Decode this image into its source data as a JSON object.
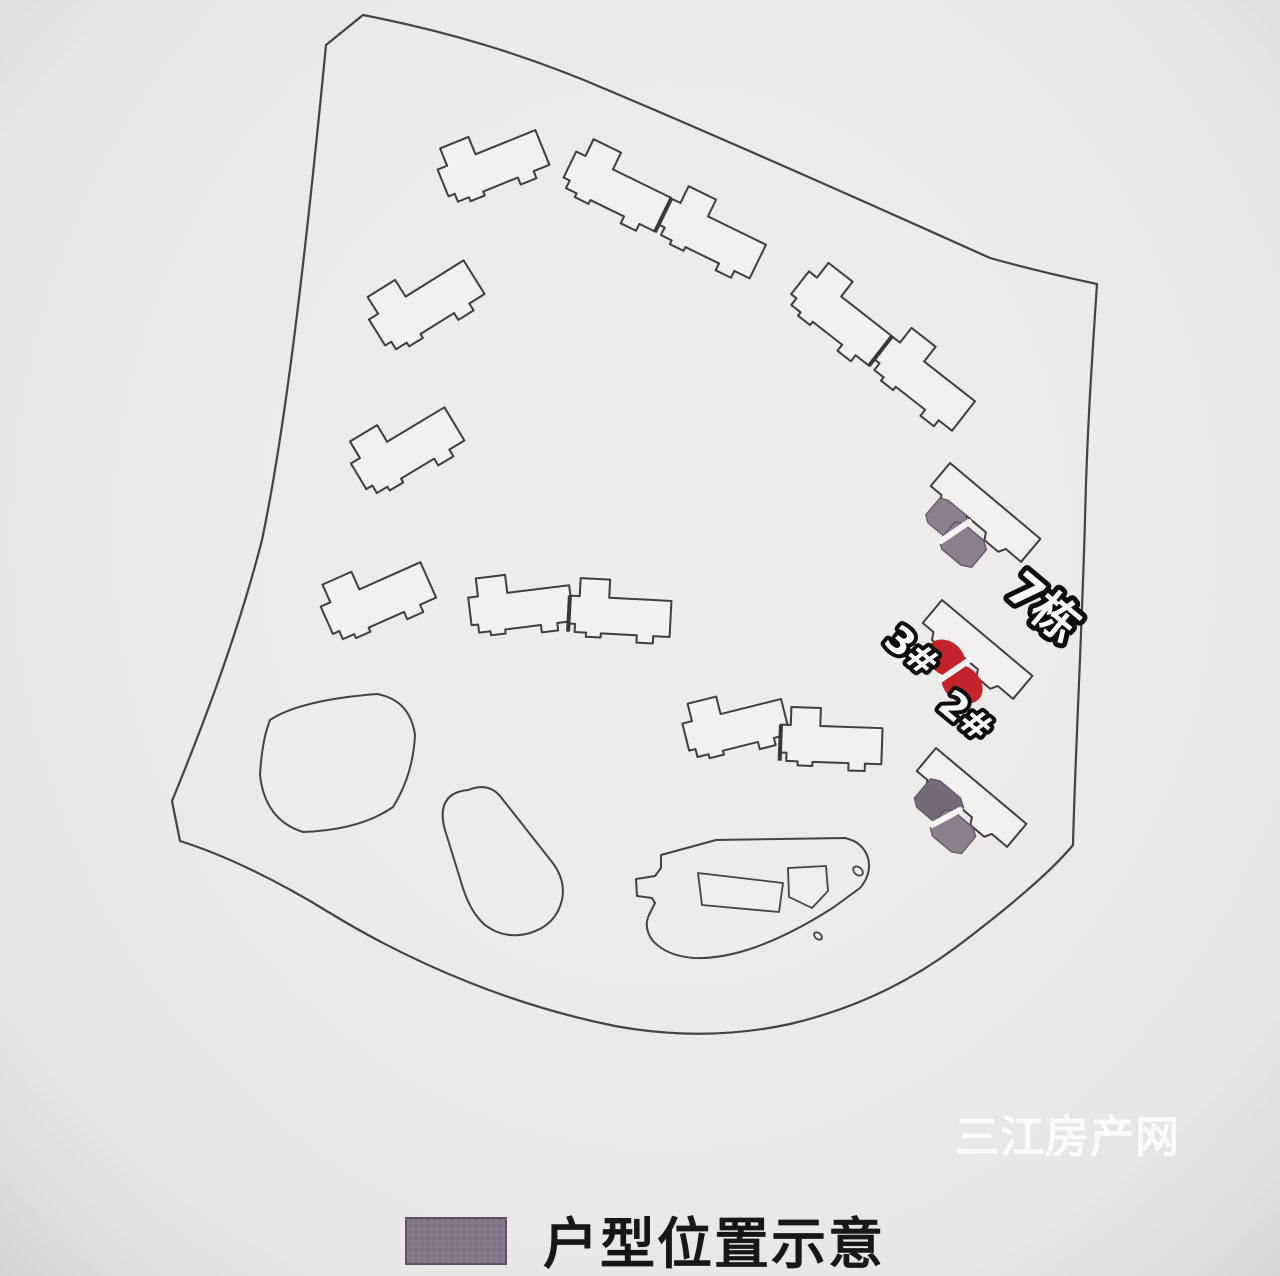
{
  "site_plan": {
    "building_label": "7栋",
    "unit_labels": [
      "3#",
      "2#"
    ],
    "legend": {
      "label": "户型位置示意",
      "swatch_color": "#86798b"
    },
    "watermark": {
      "text": "三江房产网"
    },
    "colors": {
      "selected_unit_red": "#c5232a",
      "unit_marker_purple": "#8b7f8d",
      "unit_marker_purple_dark": "#746a79",
      "outline_dark": "#403d3a",
      "building_fill": "#f3f1ef",
      "background": "#eceae8"
    }
  }
}
